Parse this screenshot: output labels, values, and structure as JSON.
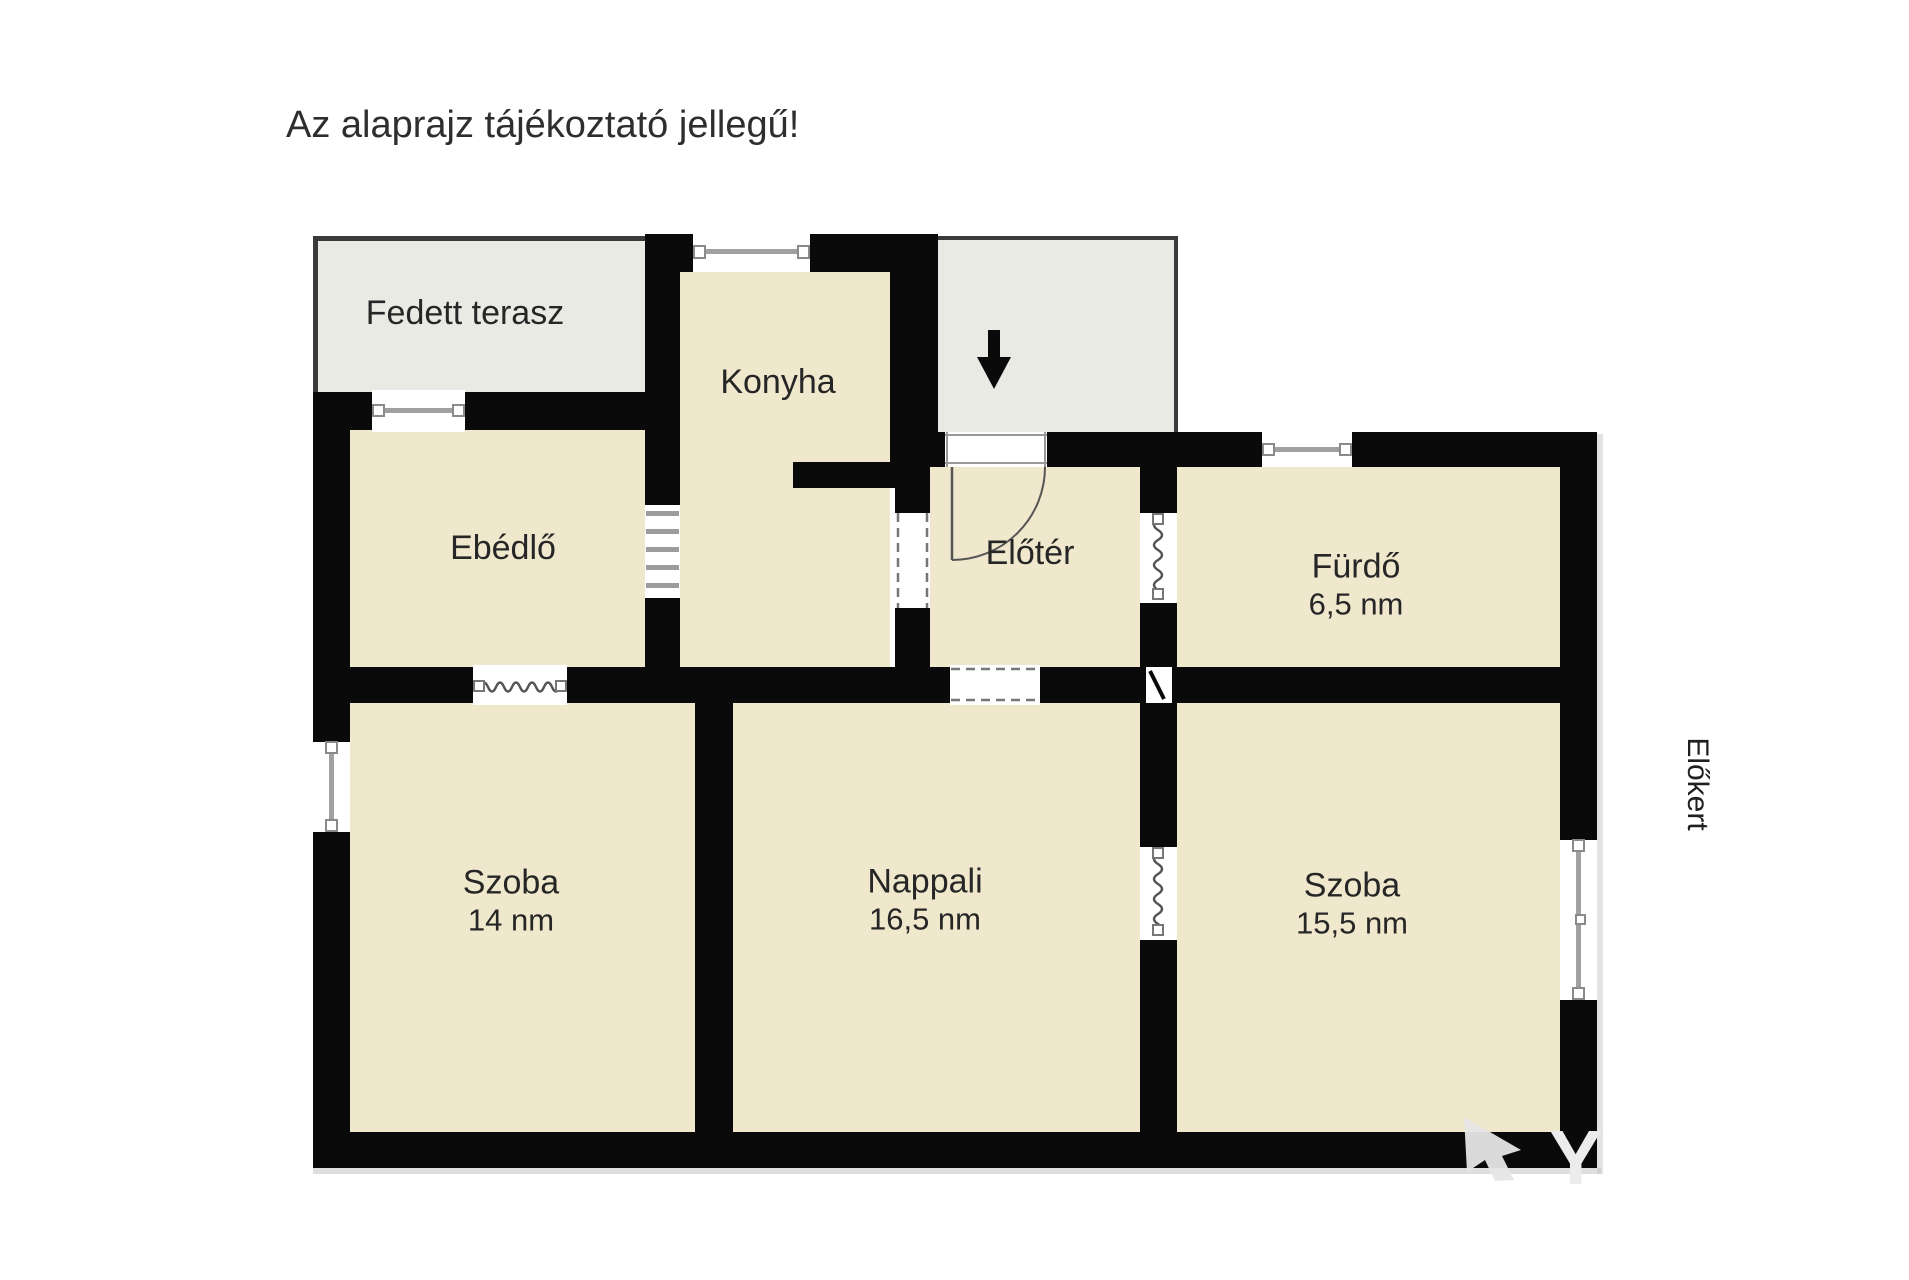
{
  "title": "Az alaprajz tájékoztató jellegű!",
  "plan": {
    "terrace_label": "Fedett terasz",
    "kitchen_label": "Konyha",
    "dining_label": "Ebédlő",
    "hall_label": "Előtér",
    "bathroom_label": "Fürdő",
    "bathroom_area": "6,5 nm",
    "room_left_label": "Szoba",
    "room_left_area": "14 nm",
    "living_label": "Nappali",
    "living_area": "16,5 nm",
    "room_right_label": "Szoba",
    "room_right_area": "15,5 nm",
    "front_garden_label": "Előkert"
  },
  "watermark": {
    "letter": "Y"
  },
  "colors": {
    "room_fill": "#f0e8cc",
    "outdoor_fill": "#eaeae5",
    "wall": "#0a0a0a",
    "thin_border": "#3a3a3a",
    "window_frame": "#9c9c9c",
    "opening_line": "#555555",
    "watermark": "#e6e6e6"
  }
}
